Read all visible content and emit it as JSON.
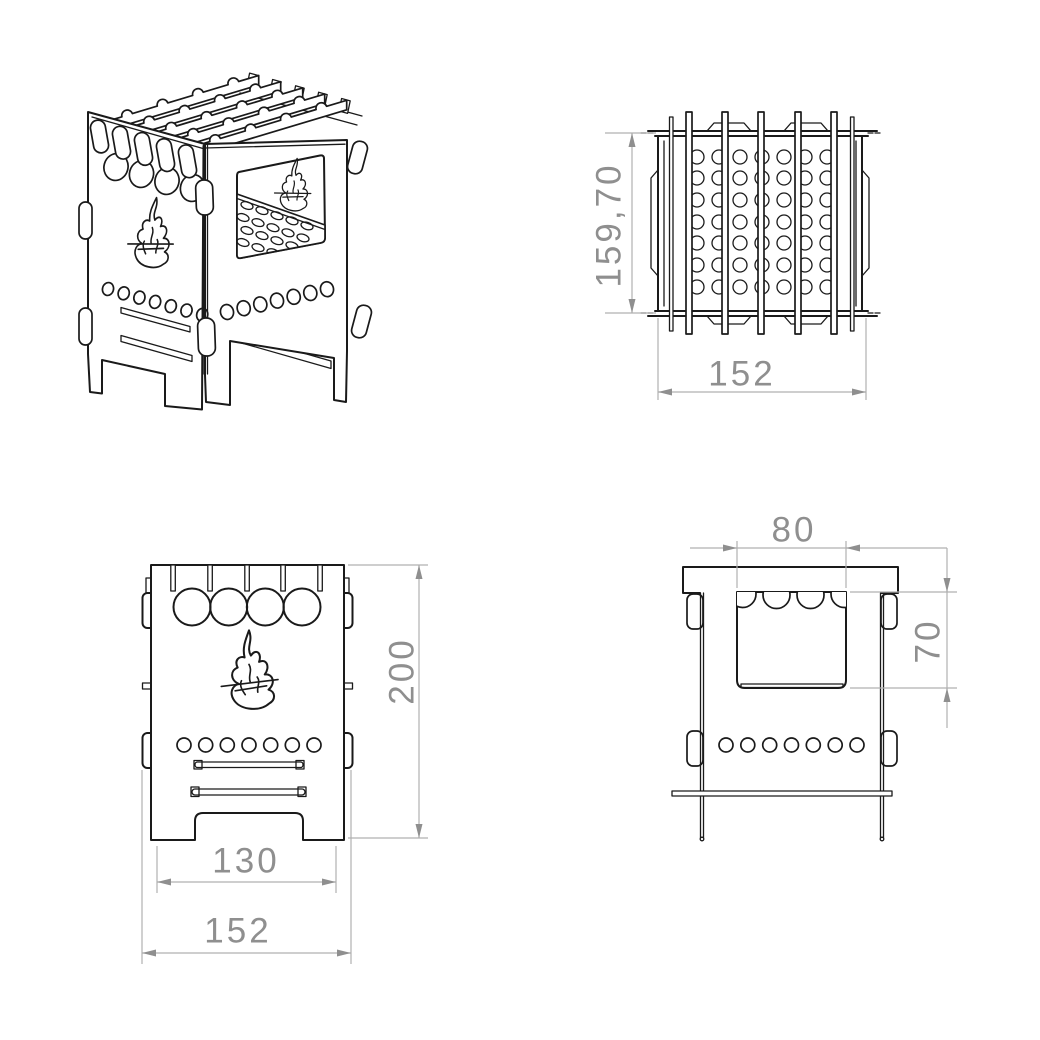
{
  "drawing": {
    "background": "#ffffff",
    "stroke_color": "#1a1a1a",
    "dimension_color": "#8f8f8f",
    "views": {
      "top_view": {
        "dim_height": "159,70",
        "dim_width": "152"
      },
      "front_view": {
        "dim_height": "200",
        "dim_leg_span": "130",
        "dim_width": "152"
      },
      "side_view": {
        "dim_window_width": "80",
        "dim_window_height": "70"
      }
    }
  }
}
